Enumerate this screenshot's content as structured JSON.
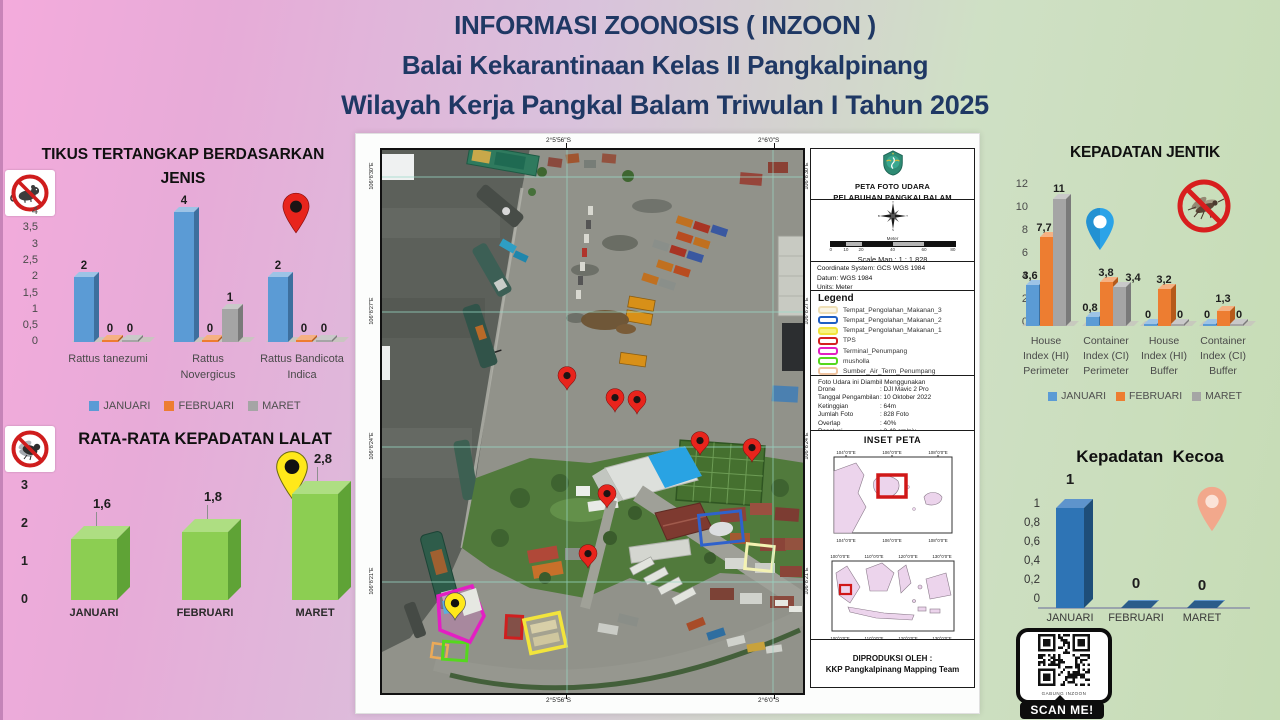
{
  "title": {
    "line1": "INFORMASI ZOONOSIS ( INZOON )",
    "line2": "Balai Kekarantinaan Kelas II Pangkalpinang",
    "line3": "Wilayah Kerja Pangkal Balam Triwulan I Tahun 2025"
  },
  "colors": {
    "title_navy": "#1F3864",
    "series_januari": "#5B9BD5",
    "series_februari": "#ED7D31",
    "series_maret": "#A5A5A5",
    "lalat_green": "#8CCE52",
    "kecoa_blue": "#2E74B5",
    "pin_red": "#E8241C",
    "pin_yellow": "#FFE81A",
    "pin_blue": "#2BA3E8",
    "pin_salmon": "#F2A88C"
  },
  "legend": {
    "months": [
      "JANUARI",
      "FEBRUARI",
      "MARET"
    ],
    "colors": [
      "#5B9BD5",
      "#ED7D31",
      "#A5A5A5"
    ]
  },
  "chart_data": [
    {
      "id": "tikus_tertangkap",
      "type": "bar",
      "title": "TIKUS TERTANGKAP BERDASARKAN JENIS",
      "title_lines": [
        "TIKUS TERTANGKAP BERDASARKAN",
        "JENIS"
      ],
      "categories": [
        "Rattus tanezumi",
        "Rattus Novergicus",
        "Rattus Bandicota Indica"
      ],
      "category_lines": [
        [
          "Rattus tanezumi"
        ],
        [
          "Rattus",
          "Novergicus"
        ],
        [
          "Rattus Bandicota",
          "Indica"
        ]
      ],
      "series": [
        {
          "name": "JANUARI",
          "color": "#5B9BD5",
          "values": [
            2,
            4,
            2
          ]
        },
        {
          "name": "FEBRUARI",
          "color": "#ED7D31",
          "values": [
            0,
            0,
            0
          ]
        },
        {
          "name": "MARET",
          "color": "#A5A5A5",
          "values": [
            0,
            1,
            0
          ]
        }
      ],
      "bar_labels": [
        [
          "2",
          "0",
          "0"
        ],
        [
          "4",
          "0",
          "1"
        ],
        [
          "2",
          "0",
          "0"
        ]
      ],
      "ylim": [
        0,
        4
      ],
      "yticks": [
        "4",
        "3,5",
        "3",
        "2,5",
        "2",
        "1,5",
        "1",
        "0,5",
        "0"
      ],
      "legend_position": "bottom",
      "grid": false
    },
    {
      "id": "rata_rata_kepadatan_lalat",
      "type": "bar",
      "title": "RATA-RATA KEPADATAN LALAT",
      "categories": [
        "JANUARI",
        "FEBRUARI",
        "MARET"
      ],
      "values": [
        1.6,
        1.8,
        2.8
      ],
      "value_labels": [
        "1,6",
        "1,8",
        "2,8"
      ],
      "ylim": [
        0,
        3
      ],
      "yticks": [
        "3",
        "2",
        "1",
        "0"
      ],
      "bar_color": "#8CCE52",
      "grid": false
    },
    {
      "id": "kepadatan_jentik",
      "type": "bar",
      "title": "KEPADATAN JENTIK",
      "categories": [
        "House Index (HI) Perimeter",
        "Container Index (CI) Perimeter",
        "House Index (HI) Buffer",
        "Container Index (CI) Buffer"
      ],
      "category_lines": [
        [
          "House",
          "Index (HI)",
          "Perimeter"
        ],
        [
          "Container",
          "Index (CI)",
          "Perimeter"
        ],
        [
          "House",
          "Index (HI)",
          "Buffer"
        ],
        [
          "Container",
          "Index (CI)",
          "Buffer"
        ]
      ],
      "series": [
        {
          "name": "JANUARI",
          "color": "#5B9BD5",
          "values": [
            3.6,
            0.8,
            0,
            0
          ]
        },
        {
          "name": "FEBRUARI",
          "color": "#ED7D31",
          "values": [
            7.7,
            3.8,
            3.2,
            1.3
          ]
        },
        {
          "name": "MARET",
          "color": "#A5A5A5",
          "values": [
            11,
            3.4,
            0,
            0
          ]
        }
      ],
      "bar_labels": [
        [
          "3,6",
          "7,7",
          "11"
        ],
        [
          "0,8",
          "3,8",
          "3,4"
        ],
        [
          "0",
          "3,2",
          "0"
        ],
        [
          "0",
          "1,3",
          "0"
        ]
      ],
      "ylim": [
        0,
        12
      ],
      "yticks": [
        "12",
        "10",
        "8",
        "6",
        "4",
        "2",
        "0"
      ],
      "legend_position": "bottom",
      "grid": false
    },
    {
      "id": "kepadatan_kecoa",
      "type": "bar",
      "title": "Kepadatan  Kecoa",
      "categories": [
        "JANUARI",
        "FEBRUARI",
        "MARET"
      ],
      "values": [
        1,
        0,
        0
      ],
      "value_labels": [
        "1",
        "0",
        "0"
      ],
      "ylim": [
        0,
        1
      ],
      "yticks": [
        "1",
        "0,8",
        "0,6",
        "0,4",
        "0,2",
        "0"
      ],
      "bar_color": "#2E74B5",
      "grid": false
    }
  ],
  "map": {
    "panel_title": [
      "PETA FOTO UDARA",
      "PELABUHAN PANGKALBALAM"
    ],
    "scale_bar_label": "Meter",
    "scale_bar_ticks": [
      "0",
      "10",
      "20",
      "40",
      "60",
      "80"
    ],
    "scale_text": "Scale Map : 1 : 1.828",
    "coordinate_lines": [
      "Coordinate System: GCS WGS 1984",
      "Datum: WGS 1984",
      "Units: Meter"
    ],
    "legend_title": "Legend",
    "legend_items": [
      {
        "label": "Tempat_Pengolahan_Makanan_3",
        "color": "#EFDFB6"
      },
      {
        "label": "Tempat_Pengolahan_Makanan_2",
        "color": "#1F5FC4"
      },
      {
        "label": "Tempat_Pengolahan_Makanan_1",
        "color": "#F2E43C"
      },
      {
        "label": "TPS",
        "color": "#D42020"
      },
      {
        "label": "Terminal_Penumpang",
        "color": "#E31FC3"
      },
      {
        "label": "musholla",
        "color": "#55D81E"
      },
      {
        "label": "Sumber_Air_Term_Penumpang",
        "color": "#EFC3A0"
      }
    ],
    "photo_info_title": "Foto Udara ini Diambil Menggunakan",
    "photo_info": [
      {
        "label": "Drone",
        "value": ": DJI Mavic 2 Pro"
      },
      {
        "label": "Tanggal Pengambilan",
        "value": ": 10 Oktober 2022"
      },
      {
        "label": "Ketinggian",
        "value": ": 64m"
      },
      {
        "label": "Jumlah Foto",
        "value": ": 828 Foto"
      },
      {
        "label": "Overlap",
        "value": ": 40%"
      },
      {
        "label": "Resolusi",
        "value": ": 3,40 cm/pix"
      }
    ],
    "inset_title": "INSET PETA",
    "inset1_xlabels": [
      "104°0'0\"E",
      "106°0'0\"E",
      "108°0'0\"E"
    ],
    "inset2_xlabels": [
      "100°0'0\"E",
      "110°0'0\"E",
      "120°0'0\"E",
      "130°0'0\"E"
    ],
    "produced_by": [
      "DIPRODUKSI OLEH :",
      "KKP Pangkalpinang Mapping Team"
    ],
    "edge_labels": {
      "top": [
        "2°5'56\"S",
        "2°6'0\"S"
      ],
      "bottom": [
        "2°5'56\"S",
        "2°6'0\"S"
      ],
      "left": [
        "106°8'30\"E",
        "106°8'27\"E",
        "106°8'24\"E",
        "106°8'21\"E"
      ],
      "right": [
        "106°8'30\"E",
        "106°8'27\"E",
        "106°8'24\"E",
        "106°8'21\"E"
      ]
    },
    "pins": {
      "red": 7,
      "yellow": 1
    }
  },
  "qr": {
    "label": "SCAN ME!",
    "caption": "GABUNG INZOON"
  }
}
